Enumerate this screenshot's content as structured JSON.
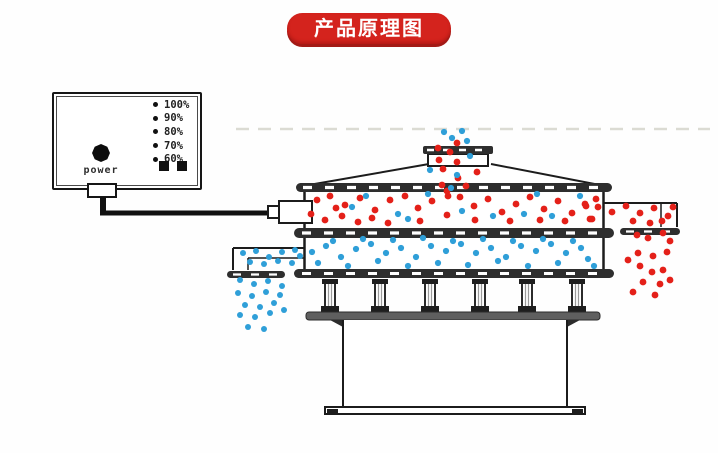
{
  "title": {
    "text": "产品原理图"
  },
  "colors": {
    "accent_red": "#d4231d",
    "particle_red": "#e42019",
    "particle_blue": "#2f9fd8",
    "line": "#1c1c1c",
    "band": "#2e2e2e"
  },
  "control_box": {
    "power_label": "power",
    "levels": [
      "100%",
      "90%",
      "80%",
      "70%",
      "60%"
    ]
  },
  "particles": {
    "groups": [
      {
        "name": "feed-stream-red",
        "color": "particle_red",
        "r": 3.4,
        "points": [
          [
            457,
            143
          ],
          [
            438,
            148
          ],
          [
            450,
            152
          ],
          [
            439,
            160
          ],
          [
            457,
            162
          ],
          [
            443,
            169
          ],
          [
            477,
            172
          ],
          [
            442,
            185
          ],
          [
            458,
            178
          ],
          [
            447,
            191
          ],
          [
            466,
            186
          ]
        ]
      },
      {
        "name": "feed-stream-blue",
        "color": "particle_blue",
        "r": 3.1,
        "points": [
          [
            452,
            138
          ],
          [
            467,
            141
          ],
          [
            430,
            170
          ],
          [
            457,
            175
          ],
          [
            451,
            188
          ],
          [
            470,
            156
          ],
          [
            462,
            131
          ],
          [
            444,
            132
          ]
        ]
      },
      {
        "name": "upper-deck-oversize-red",
        "color": "particle_red",
        "r": 3.4,
        "points": [
          [
            317,
            200
          ],
          [
            330,
            196
          ],
          [
            345,
            205
          ],
          [
            360,
            198
          ],
          [
            375,
            210
          ],
          [
            390,
            200
          ],
          [
            405,
            196
          ],
          [
            418,
            208
          ],
          [
            432,
            201
          ],
          [
            447,
            215
          ],
          [
            311,
            214
          ],
          [
            325,
            220
          ],
          [
            342,
            216
          ],
          [
            358,
            222
          ],
          [
            372,
            218
          ],
          [
            388,
            223
          ],
          [
            460,
            197
          ],
          [
            474,
            206
          ],
          [
            488,
            199
          ],
          [
            502,
            212
          ],
          [
            516,
            204
          ],
          [
            530,
            197
          ],
          [
            544,
            209
          ],
          [
            558,
            201
          ],
          [
            572,
            213
          ],
          [
            586,
            206
          ],
          [
            596,
            199
          ],
          [
            540,
            220
          ],
          [
            565,
            221
          ],
          [
            590,
            219
          ],
          [
            475,
            220
          ],
          [
            420,
            221
          ],
          [
            448,
            196
          ],
          [
            510,
            221
          ],
          [
            336,
            208
          ]
        ]
      },
      {
        "name": "upper-deck-blue",
        "color": "particle_blue",
        "r": 3.1,
        "points": [
          [
            352,
            207
          ],
          [
            398,
            214
          ],
          [
            428,
            194
          ],
          [
            462,
            211
          ],
          [
            493,
            216
          ],
          [
            524,
            214
          ],
          [
            552,
            216
          ],
          [
            580,
            196
          ],
          [
            408,
            219
          ],
          [
            366,
            196
          ],
          [
            537,
            194
          ]
        ]
      },
      {
        "name": "coarse-outlet-red",
        "color": "particle_red",
        "r": 3.4,
        "points": [
          [
            585,
            204
          ],
          [
            592,
            219
          ],
          [
            598,
            207
          ],
          [
            612,
            212
          ],
          [
            626,
            206
          ],
          [
            640,
            213
          ],
          [
            654,
            208
          ],
          [
            633,
            221
          ],
          [
            650,
            223
          ],
          [
            668,
            216
          ],
          [
            673,
            207
          ],
          [
            662,
            221
          ],
          [
            637,
            235
          ],
          [
            648,
            238
          ],
          [
            663,
            233
          ],
          [
            670,
            241
          ],
          [
            638,
            253
          ],
          [
            653,
            256
          ],
          [
            667,
            252
          ],
          [
            628,
            260
          ],
          [
            640,
            266
          ],
          [
            652,
            272
          ],
          [
            663,
            270
          ],
          [
            643,
            282
          ],
          [
            660,
            284
          ],
          [
            670,
            280
          ],
          [
            633,
            292
          ],
          [
            655,
            295
          ]
        ]
      },
      {
        "name": "lower-deck-fines-blue",
        "color": "particle_blue",
        "r": 3.1,
        "points": [
          [
            312,
            252
          ],
          [
            326,
            246
          ],
          [
            341,
            257
          ],
          [
            356,
            249
          ],
          [
            371,
            244
          ],
          [
            386,
            253
          ],
          [
            401,
            248
          ],
          [
            416,
            257
          ],
          [
            431,
            246
          ],
          [
            446,
            251
          ],
          [
            461,
            244
          ],
          [
            476,
            253
          ],
          [
            491,
            248
          ],
          [
            506,
            257
          ],
          [
            521,
            246
          ],
          [
            536,
            251
          ],
          [
            551,
            244
          ],
          [
            566,
            253
          ],
          [
            581,
            248
          ],
          [
            318,
            263
          ],
          [
            348,
            266
          ],
          [
            378,
            261
          ],
          [
            408,
            266
          ],
          [
            438,
            263
          ],
          [
            468,
            265
          ],
          [
            498,
            261
          ],
          [
            528,
            266
          ],
          [
            558,
            263
          ],
          [
            588,
            259
          ],
          [
            333,
            241
          ],
          [
            363,
            239
          ],
          [
            393,
            240
          ],
          [
            423,
            238
          ],
          [
            453,
            241
          ],
          [
            483,
            239
          ],
          [
            513,
            241
          ],
          [
            543,
            239
          ],
          [
            573,
            241
          ],
          [
            594,
            266
          ]
        ]
      },
      {
        "name": "fine-outlet-blue",
        "color": "particle_blue",
        "r": 3.0,
        "points": [
          [
            243,
            253
          ],
          [
            256,
            251
          ],
          [
            269,
            257
          ],
          [
            282,
            252
          ],
          [
            295,
            250
          ],
          [
            250,
            262
          ],
          [
            264,
            264
          ],
          [
            278,
            261
          ],
          [
            292,
            263
          ],
          [
            300,
            256
          ],
          [
            240,
            280
          ],
          [
            254,
            284
          ],
          [
            268,
            281
          ],
          [
            282,
            286
          ],
          [
            238,
            293
          ],
          [
            252,
            296
          ],
          [
            266,
            292
          ],
          [
            280,
            295
          ],
          [
            245,
            305
          ],
          [
            260,
            307
          ],
          [
            274,
            303
          ],
          [
            240,
            315
          ],
          [
            255,
            317
          ],
          [
            270,
            313
          ],
          [
            284,
            310
          ],
          [
            248,
            327
          ],
          [
            264,
            329
          ]
        ]
      }
    ]
  }
}
